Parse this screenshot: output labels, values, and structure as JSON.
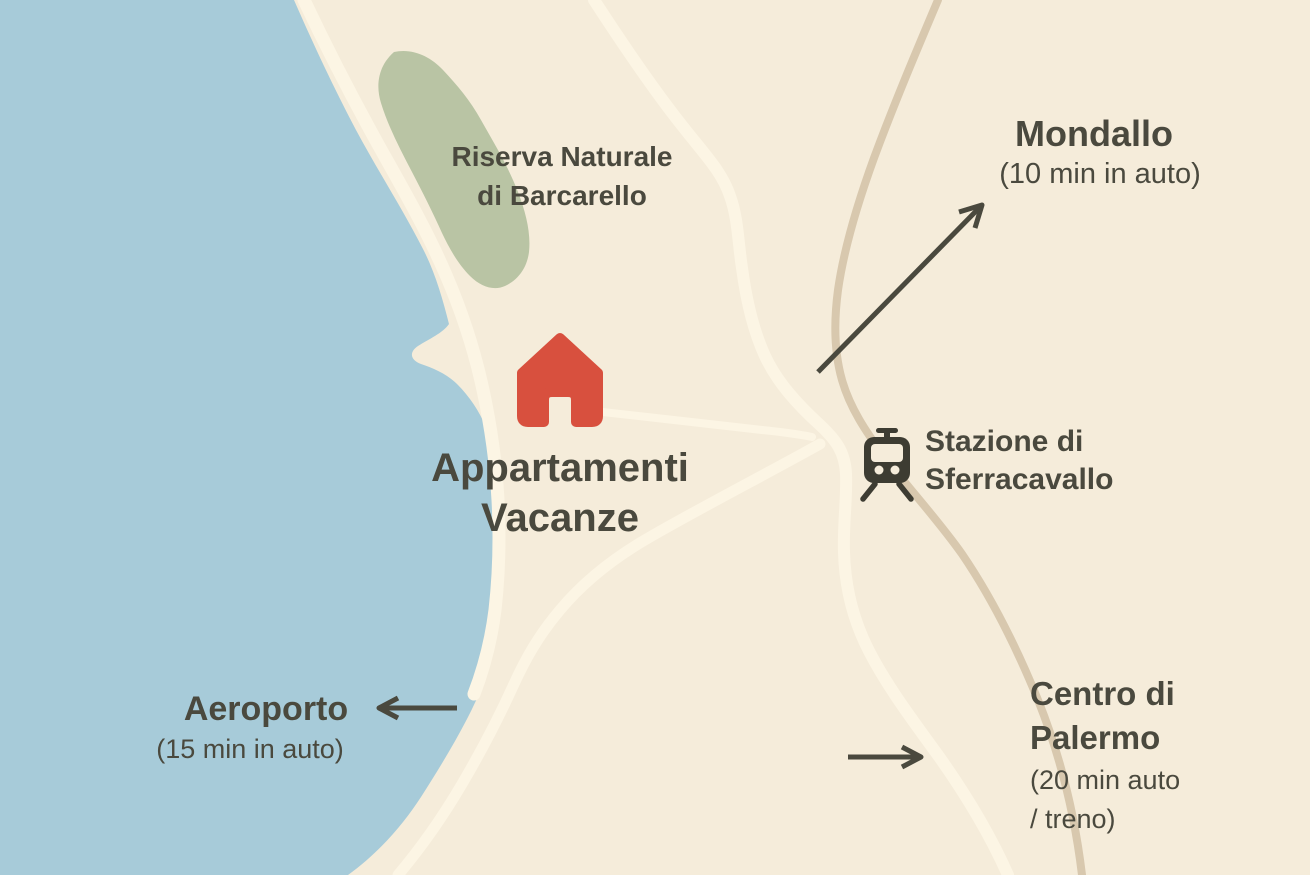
{
  "map": {
    "colors": {
      "water": "#a7cbd9",
      "land": "#f5ecda",
      "reserve_green": "#b9c4a4",
      "road_light": "#fcf5e4",
      "road_tan": "#d8c8ae",
      "ink": "#4a493e",
      "house_red": "#d8503e",
      "icon_dark": "#3d3c32"
    },
    "labels": {
      "reserve_line1": "Riserva Naturale",
      "reserve_line2": "di Barcarello",
      "apartments_line1": "Appartamenti",
      "apartments_line2": "Vacanze",
      "station_line1": "Stazione di",
      "station_line2": "Sferracavallo",
      "mondallo_name": "Mondallo",
      "mondallo_detail": "(10 min in auto)",
      "airport_name": "Aeroporto",
      "airport_detail": "(15 min in auto)",
      "palermo_name_line1": "Centro di",
      "palermo_name_line2": "Palermo",
      "palermo_detail_line1": "(20 min auto",
      "palermo_detail_line2": "/ treno)"
    },
    "icons": {
      "house": "house-icon",
      "train": "train-station-icon",
      "mondallo_arrow": "arrow-up-right-icon",
      "airport_arrow": "arrow-left-icon",
      "palermo_arrow": "arrow-right-icon"
    }
  }
}
